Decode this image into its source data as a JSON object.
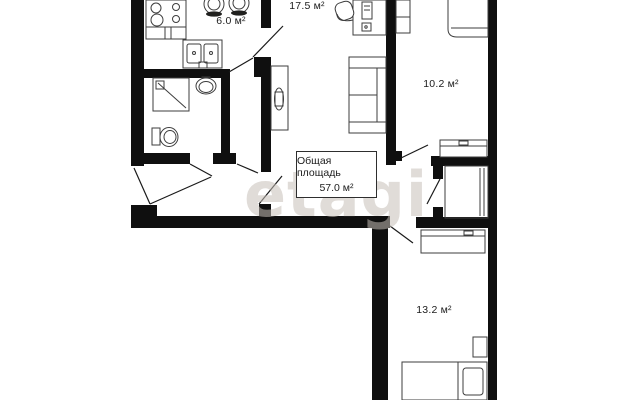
{
  "plan": {
    "watermark": "etagi",
    "total_area_box": {
      "title": "Общая площадь",
      "value": "57.0 м²"
    },
    "rooms": {
      "kitchen": {
        "area_label": "6.0 м²"
      },
      "living_room": {
        "area_label": "17.5 м²"
      },
      "bedroom_small": {
        "area_label": "10.2 м²"
      },
      "bedroom_large": {
        "area_label": "13.2 м²"
      }
    },
    "colors": {
      "wall": "#0f0f0f",
      "furniture_line": "#3d3d3d",
      "text": "#1c1c1c",
      "watermark": "rgba(198,191,184,0.55)"
    }
  }
}
